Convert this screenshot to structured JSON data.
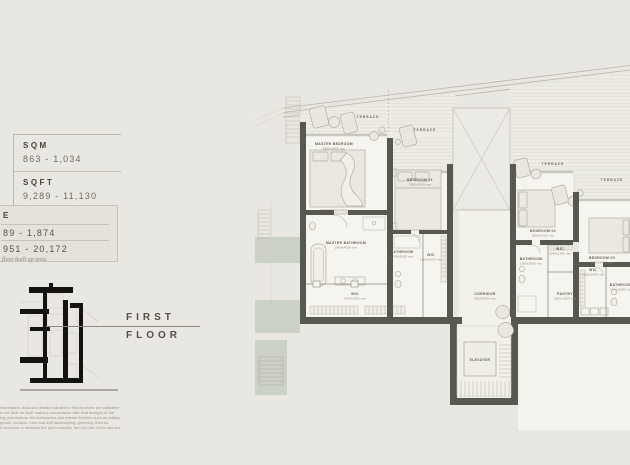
{
  "stats": {
    "sqm_label": "SQM",
    "sqm_value": "863 - 1,034",
    "sqft_label": "SQFT",
    "sqft_value": "9,289 - 11,130",
    "total_box": {
      "title_fragment": "E",
      "row1_fragment": "89 - 1,874",
      "row2_fragment": "951 - 20,172"
    },
    "footnote_fragment": "floor built up area."
  },
  "floor_label": {
    "line1": "FIRST",
    "line2": "FLOOR"
  },
  "disclaimer_lines": [
    "information, data and details included in this brochure are indicative",
    "in the final 'as built' status in accordance with final designs of the",
    "ing permissions. All accessories and interior finishes such as wallpaper,",
    "goods, curtains, hard and soft landscaping, greenery, fixtures,",
    "e brochure or between the plot boundary, are not part of the unit and"
  ],
  "plan": {
    "terrace_labels": [
      "TERRACE",
      "TERRACE",
      "TERRACE",
      "TERRACE"
    ],
    "rooms": [
      {
        "name": "MASTER BEDROOM",
        "dims": "4500x5400 mm"
      },
      {
        "name": "BEDROOM 01",
        "dims": "3300x5100 mm"
      },
      {
        "name": "MASTER BATHROOM",
        "dims": "2900x4000 mm"
      },
      {
        "name": "BATHROOM",
        "dims": "1700x3000 mm"
      },
      {
        "name": "WIC",
        "dims": "1100x3000 mm"
      },
      {
        "name": "WIC",
        "dims": "4200x1800 mm"
      },
      {
        "name": "BEDROOM 02",
        "dims": "3500x4700 mm"
      },
      {
        "name": "WIC",
        "dims": "2040x1100 mm"
      },
      {
        "name": "BATHROOM",
        "dims": "1900x3000 mm"
      },
      {
        "name": "BEDROOM 03",
        "dims": "3300x4200 mm"
      },
      {
        "name": "WIC",
        "dims": "1100x2400 mm"
      },
      {
        "name": "BATHROOM",
        "dims": "1700x2400 mm"
      },
      {
        "name": "CORRIDOR",
        "dims": "3400x4900 mm"
      },
      {
        "name": "PANTRY",
        "dims": "2600x1800 mm"
      },
      {
        "name": "ELEVATOR",
        "dims": ""
      }
    ]
  },
  "colors": {
    "background": "#e9e7e1",
    "wall": "#57584f",
    "room_fill": "#f5f4ee",
    "terrace_fill": "#edece5",
    "planter": "#ccd1c5",
    "leader_line": "#8d897f",
    "label_text": "#615d54"
  }
}
